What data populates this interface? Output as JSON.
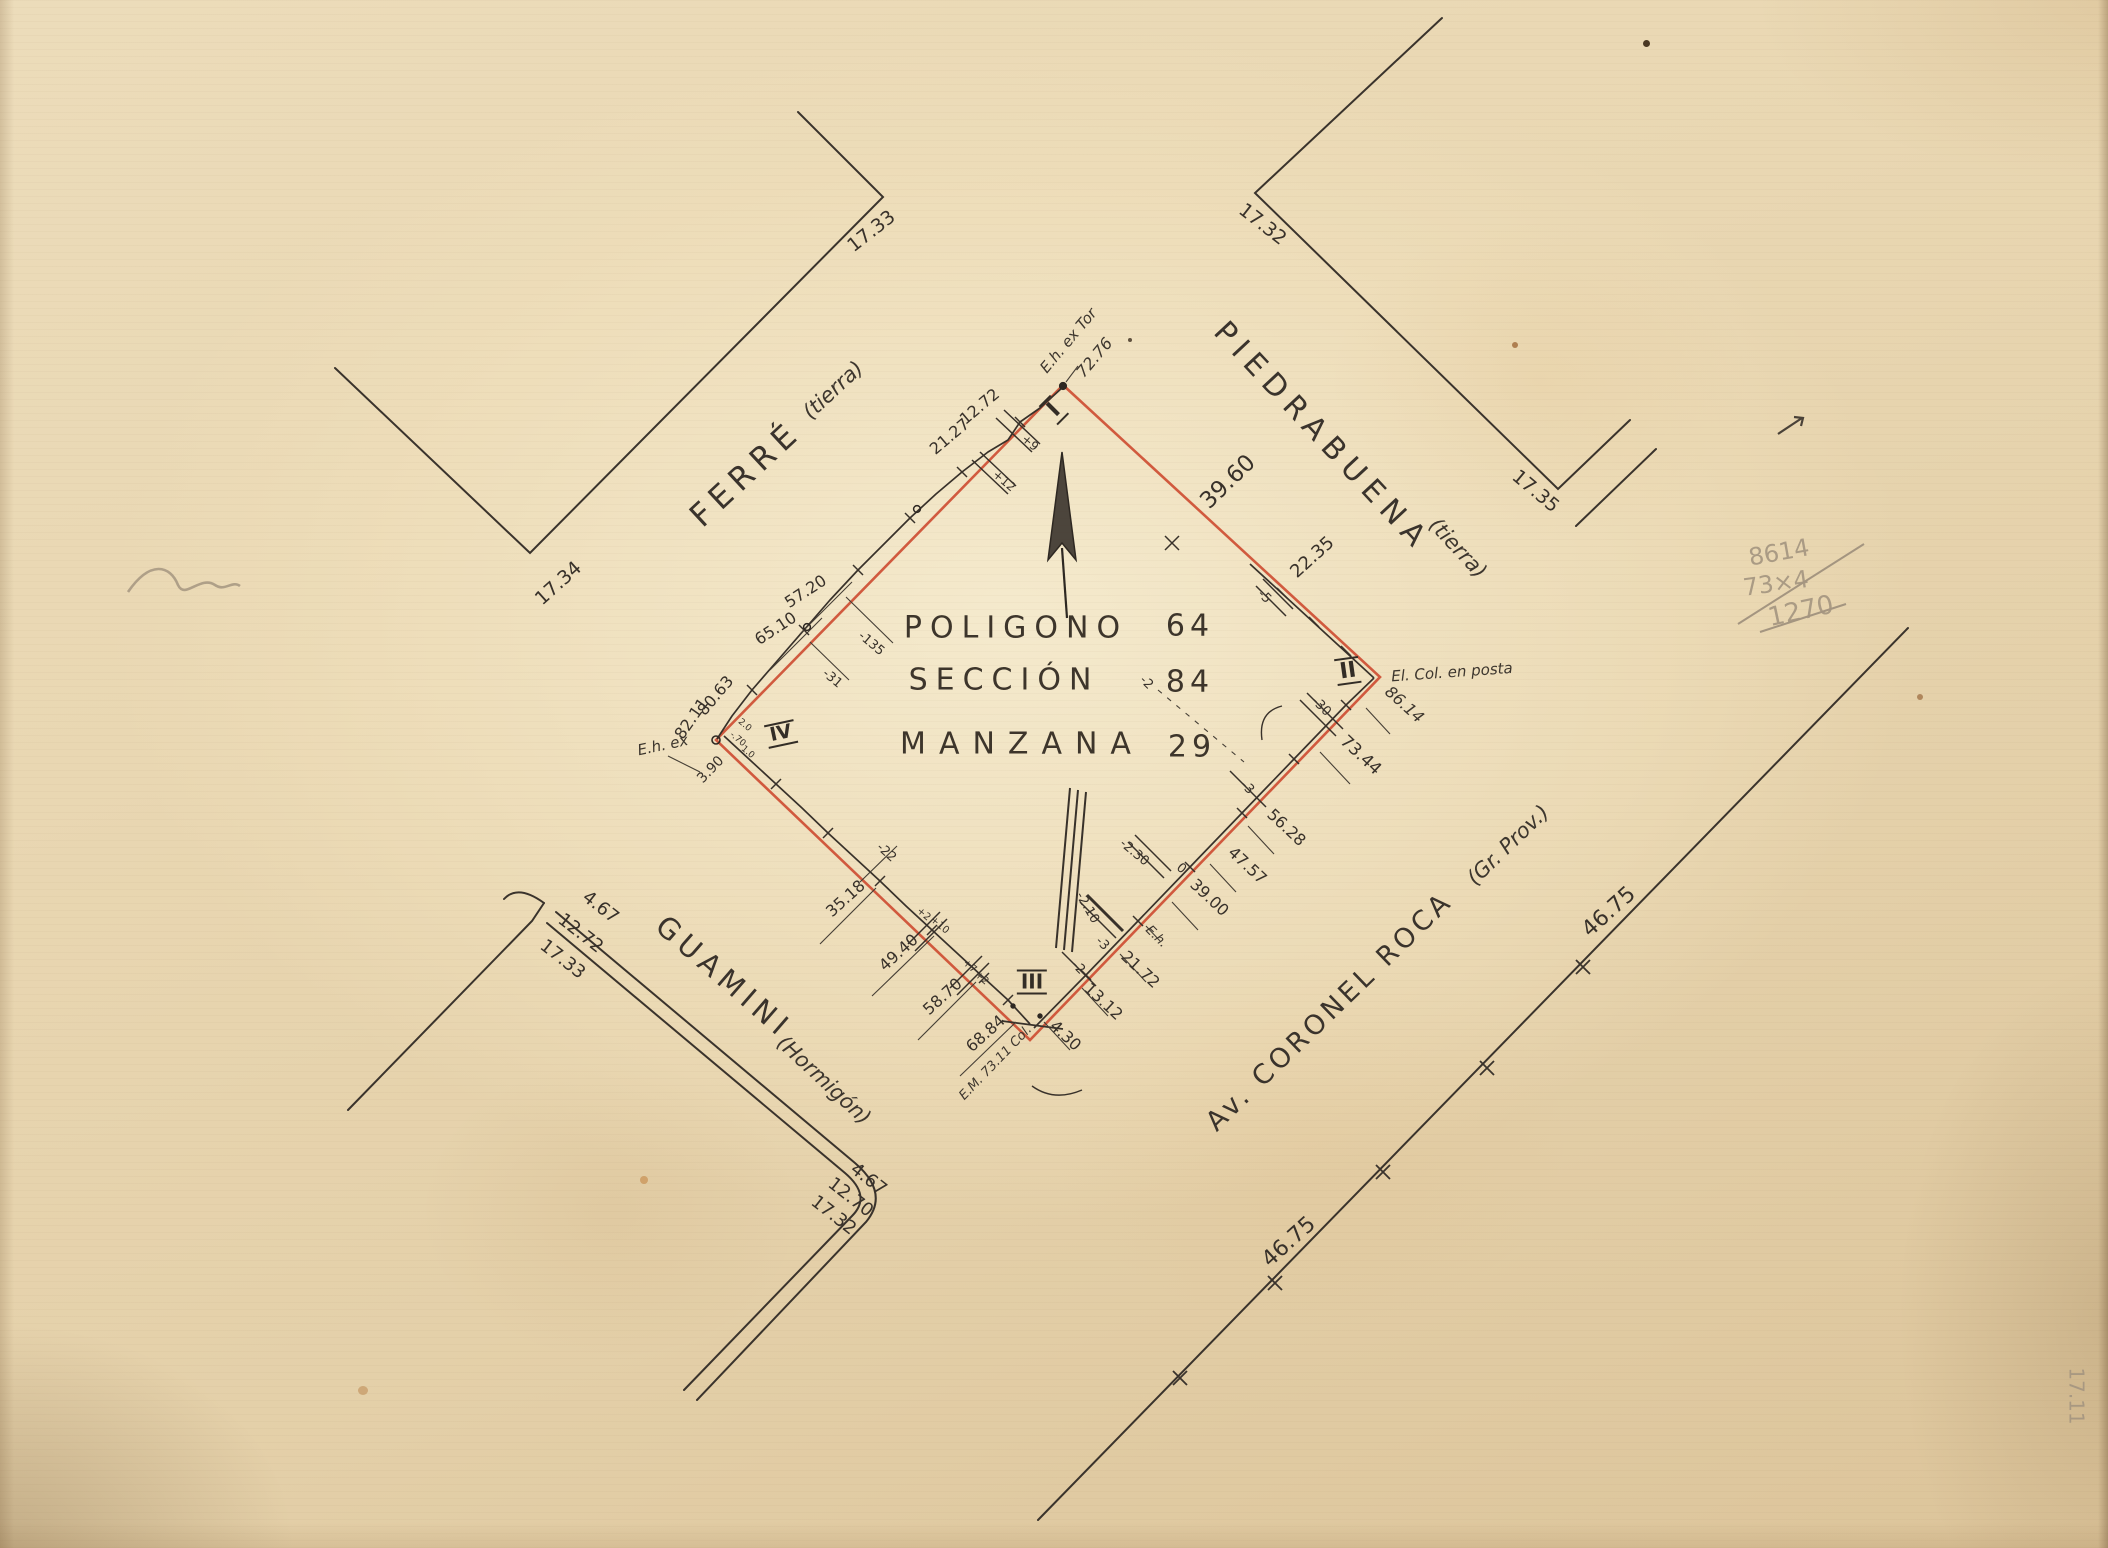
{
  "document": {
    "kind": "hand-drawn cadastral survey plan, scanned on aged paper",
    "block_title": {
      "polygon_label": "POLIGONO",
      "polygon_value": "64",
      "section_label": "SECCIÓN",
      "section_value": "84",
      "block_label": "MANZANA",
      "block_value": "29"
    }
  },
  "colors": {
    "boundary_red": "#cd4a30",
    "ink": "#38312a",
    "pencil": "#a49580",
    "paper": "#e9d7b2"
  },
  "labels": {
    "title": [
      {
        "id": "title-poligono",
        "text": "POLIGONO",
        "x": 1016,
        "y": 628,
        "rot": 0,
        "size": 30,
        "ls": 8,
        "style": "title"
      },
      {
        "id": "title-poligono-value",
        "text": "64",
        "x": 1190,
        "y": 626,
        "rot": 0,
        "size": 30,
        "ls": 5,
        "style": "title"
      },
      {
        "id": "title-seccion",
        "text": "SECCIÓN",
        "x": 1004,
        "y": 680,
        "rot": 0,
        "size": 30,
        "ls": 8,
        "style": "title"
      },
      {
        "id": "title-seccion-value",
        "text": "84",
        "x": 1190,
        "y": 682,
        "rot": 0,
        "size": 30,
        "ls": 5,
        "style": "title"
      },
      {
        "id": "title-manzana",
        "text": "MANZANA",
        "x": 1022,
        "y": 744,
        "rot": 0,
        "size": 30,
        "ls": 13,
        "style": "title"
      },
      {
        "id": "title-manzana-value",
        "text": "29",
        "x": 1192,
        "y": 747,
        "rot": 0,
        "size": 30,
        "ls": 5,
        "style": "title"
      }
    ],
    "streets": [
      {
        "id": "street-ferre",
        "text": "FERRÉ",
        "x": 746,
        "y": 474,
        "rot": -43,
        "size": 32,
        "ls": 7,
        "style": "street"
      },
      {
        "id": "street-ferre-surface",
        "text": "(tierra)",
        "x": 833,
        "y": 390,
        "rot": -43,
        "size": 21,
        "style": "hand"
      },
      {
        "id": "street-piedrabuena",
        "text": "PIEDRABUENA",
        "x": 1322,
        "y": 437,
        "rot": 47,
        "size": 30,
        "ls": 8,
        "style": "street"
      },
      {
        "id": "street-piedrabuena-surface",
        "text": "(tierra)",
        "x": 1458,
        "y": 548,
        "rot": 47,
        "size": 21,
        "style": "hand"
      },
      {
        "id": "street-guamini",
        "text": "GUAMINI",
        "x": 724,
        "y": 977,
        "rot": 41,
        "size": 29,
        "ls": 6,
        "style": "street"
      },
      {
        "id": "street-guamini-surface",
        "text": "(Hormigón)",
        "x": 824,
        "y": 1080,
        "rot": 43,
        "size": 21,
        "style": "hand"
      },
      {
        "id": "street-coronel-roca",
        "text": "Av. CORONEL ROCA",
        "x": 1330,
        "y": 1012,
        "rot": -44,
        "size": 27,
        "ls": 4,
        "style": "street"
      },
      {
        "id": "street-coronel-roca-surface",
        "text": "(Gr. Prov.)",
        "x": 1508,
        "y": 845,
        "rot": -44,
        "size": 21,
        "style": "hand"
      }
    ],
    "corner_dimensions": [
      {
        "id": "corner-dim",
        "text": "17.33",
        "x": 872,
        "y": 232,
        "rot": -38,
        "size": 19
      },
      {
        "id": "corner-dim",
        "text": "17.32",
        "x": 1262,
        "y": 225,
        "rot": 38,
        "size": 19
      },
      {
        "id": "corner-dim",
        "text": "17.34",
        "x": 559,
        "y": 584,
        "rot": -42,
        "size": 19
      },
      {
        "id": "corner-dim",
        "text": "17.35",
        "x": 1535,
        "y": 492,
        "rot": 40,
        "size": 19
      },
      {
        "id": "corner-dim",
        "text": "4.67",
        "x": 600,
        "y": 908,
        "rot": 38,
        "size": 18
      },
      {
        "id": "corner-dim",
        "text": "12.72",
        "x": 580,
        "y": 934,
        "rot": 38,
        "size": 18
      },
      {
        "id": "corner-dim",
        "text": "17.33",
        "x": 562,
        "y": 960,
        "rot": 38,
        "size": 18
      },
      {
        "id": "corner-dim",
        "text": "4.67",
        "x": 868,
        "y": 1180,
        "rot": 38,
        "size": 18
      },
      {
        "id": "corner-dim",
        "text": "12.70",
        "x": 850,
        "y": 1198,
        "rot": 38,
        "size": 18
      },
      {
        "id": "corner-dim",
        "text": "17.32",
        "x": 833,
        "y": 1216,
        "rot": 38,
        "size": 18
      },
      {
        "id": "roca-dim",
        "text": "46.75",
        "x": 1609,
        "y": 912,
        "rot": -42,
        "size": 22
      },
      {
        "id": "roca-dim",
        "text": "46.75",
        "x": 1289,
        "y": 1242,
        "rot": -42,
        "size": 22
      }
    ],
    "vertex_marks": [
      {
        "id": "vertex-i",
        "text": "I",
        "x": 1054,
        "y": 410,
        "rot": -45,
        "size": 22,
        "style": "roman"
      },
      {
        "id": "vertex-ii",
        "text": "II",
        "x": 1348,
        "y": 671,
        "rot": -8,
        "size": 22,
        "style": "roman"
      },
      {
        "id": "vertex-iii",
        "text": "III",
        "x": 1032,
        "y": 982,
        "rot": 0,
        "size": 20,
        "style": "roman"
      },
      {
        "id": "vertex-iv",
        "text": "IV",
        "x": 781,
        "y": 734,
        "rot": -12,
        "size": 19,
        "style": "roman"
      }
    ],
    "monuments": [
      {
        "id": "monument-note",
        "text": "E.h. ex Tor",
        "x": 1069,
        "y": 341,
        "rot": -50,
        "size": 15,
        "style": "hand"
      },
      {
        "id": "monument-note",
        "text": "72.76",
        "x": 1095,
        "y": 358,
        "rot": -50,
        "size": 16,
        "style": "hand"
      },
      {
        "id": "monument-note",
        "text": "El. Col. en posta",
        "x": 1452,
        "y": 673,
        "rot": -4,
        "size": 15,
        "style": "hand"
      },
      {
        "id": "monument-note",
        "text": "86.14",
        "x": 1404,
        "y": 705,
        "rot": 42,
        "size": 16,
        "style": "hand"
      },
      {
        "id": "monument-note",
        "text": "E.h. ex",
        "x": 663,
        "y": 746,
        "rot": -12,
        "size": 15,
        "style": "hand"
      },
      {
        "id": "monument-note",
        "text": "E.M. 73.11 Col.",
        "x": 996,
        "y": 1063,
        "rot": -46,
        "size": 13,
        "style": "hand"
      },
      {
        "id": "monument-note",
        "text": "E.h.",
        "x": 1156,
        "y": 937,
        "rot": 45,
        "size": 13,
        "style": "hand"
      }
    ],
    "edge_dimensions": [
      {
        "id": "edge-dim",
        "text": "39.60",
        "x": 1228,
        "y": 482,
        "rot": -44,
        "size": 23
      },
      {
        "id": "edge-dim",
        "text": "22.35",
        "x": 1313,
        "y": 558,
        "rot": -42,
        "size": 18
      },
      {
        "id": "edge-dim",
        "text": "12.72",
        "x": 980,
        "y": 407,
        "rot": -40,
        "size": 16
      },
      {
        "id": "edge-dim",
        "text": "21.27",
        "x": 950,
        "y": 437,
        "rot": -40,
        "size": 16
      },
      {
        "id": "edge-dim",
        "text": "57.20",
        "x": 806,
        "y": 592,
        "rot": -33,
        "size": 16
      },
      {
        "id": "edge-dim",
        "text": "65.10",
        "x": 776,
        "y": 629,
        "rot": -33,
        "size": 16
      },
      {
        "id": "edge-dim",
        "text": "80.63",
        "x": 716,
        "y": 696,
        "rot": -50,
        "size": 16
      },
      {
        "id": "edge-dim",
        "text": "82.11",
        "x": 692,
        "y": 719,
        "rot": -55,
        "size": 16
      },
      {
        "id": "edge-dim",
        "text": "3.90",
        "x": 711,
        "y": 770,
        "rot": -46,
        "size": 14
      },
      {
        "id": "edge-dim",
        "text": "35.18",
        "x": 846,
        "y": 899,
        "rot": -42,
        "size": 16
      },
      {
        "id": "edge-dim",
        "text": "49.40",
        "x": 899,
        "y": 953,
        "rot": -42,
        "size": 16
      },
      {
        "id": "edge-dim",
        "text": "58.70",
        "x": 943,
        "y": 997,
        "rot": -42,
        "size": 16
      },
      {
        "id": "edge-dim",
        "text": "68.84",
        "x": 986,
        "y": 1034,
        "rot": -42,
        "size": 16
      },
      {
        "id": "edge-dim",
        "text": "4.30",
        "x": 1065,
        "y": 1036,
        "rot": 43,
        "size": 16
      },
      {
        "id": "edge-dim",
        "text": "13.12",
        "x": 1103,
        "y": 1002,
        "rot": 43,
        "size": 16
      },
      {
        "id": "edge-dim",
        "text": "21.72",
        "x": 1140,
        "y": 970,
        "rot": 43,
        "size": 16
      },
      {
        "id": "edge-dim",
        "text": "39.00",
        "x": 1209,
        "y": 898,
        "rot": 43,
        "size": 16
      },
      {
        "id": "edge-dim",
        "text": "47.57",
        "x": 1247,
        "y": 866,
        "rot": 43,
        "size": 16
      },
      {
        "id": "edge-dim",
        "text": "56.28",
        "x": 1286,
        "y": 828,
        "rot": 43,
        "size": 16
      },
      {
        "id": "edge-dim",
        "text": "73.44",
        "x": 1360,
        "y": 756,
        "rot": 43,
        "size": 17
      }
    ],
    "offsets": [
      {
        "id": "offset-dim",
        "text": "+9",
        "x": 1030,
        "y": 443,
        "rot": 40,
        "size": 12
      },
      {
        "id": "offset-dim",
        "text": "+12",
        "x": 1004,
        "y": 481,
        "rot": 40,
        "size": 12
      },
      {
        "id": "offset-dim",
        "text": "-135",
        "x": 871,
        "y": 644,
        "rot": 40,
        "size": 13
      },
      {
        "id": "offset-dim",
        "text": "-31",
        "x": 832,
        "y": 679,
        "rot": 40,
        "size": 13
      },
      {
        "id": "offset-dim",
        "text": "-5",
        "x": 1264,
        "y": 597,
        "rot": 45,
        "size": 13
      },
      {
        "id": "offset-dim",
        "text": "-30",
        "x": 1321,
        "y": 707,
        "rot": 45,
        "size": 13
      },
      {
        "id": "offset-dim",
        "text": "-3",
        "x": 1247,
        "y": 788,
        "rot": 45,
        "size": 13
      },
      {
        "id": "offset-dim",
        "text": "-2",
        "x": 1146,
        "y": 683,
        "rot": 45,
        "size": 13
      },
      {
        "id": "offset-dim",
        "text": "-2.30",
        "x": 1134,
        "y": 853,
        "rot": 40,
        "size": 13
      },
      {
        "id": "offset-dim",
        "text": "0",
        "x": 1181,
        "y": 869,
        "rot": 40,
        "size": 13
      },
      {
        "id": "offset-dim",
        "text": "-2.10",
        "x": 1087,
        "y": 908,
        "rot": 60,
        "size": 13
      },
      {
        "id": "offset-dim",
        "text": "-3",
        "x": 1102,
        "y": 944,
        "rot": 45,
        "size": 13
      },
      {
        "id": "offset-dim",
        "text": "-2",
        "x": 1078,
        "y": 968,
        "rot": 45,
        "size": 13
      },
      {
        "id": "offset-dim",
        "text": "-22",
        "x": 886,
        "y": 853,
        "rot": 42,
        "size": 13
      },
      {
        "id": "offset-dim",
        "text": "+2",
        "x": 923,
        "y": 915,
        "rot": 40,
        "size": 10
      },
      {
        "id": "offset-dim",
        "text": "+10",
        "x": 939,
        "y": 926,
        "rot": 40,
        "size": 10
      },
      {
        "id": "offset-dim",
        "text": "+7",
        "x": 969,
        "y": 967,
        "rot": 40,
        "size": 10
      },
      {
        "id": "offset-dim",
        "text": "+2",
        "x": 981,
        "y": 979,
        "rot": 40,
        "size": 10
      },
      {
        "id": "offset-dim",
        "text": "2.0",
        "x": 744,
        "y": 726,
        "rot": 40,
        "size": 9
      },
      {
        "id": "offset-dim",
        "text": "-.70",
        "x": 737,
        "y": 740,
        "rot": 40,
        "size": 9
      },
      {
        "id": "offset-dim",
        "text": "1.0",
        "x": 747,
        "y": 753,
        "rot": 40,
        "size": 9
      }
    ],
    "pencil_notes": [
      {
        "id": "pencil-calc-line",
        "text": "8614",
        "x": 1779,
        "y": 553,
        "rot": -10,
        "size": 24,
        "style": "pencil"
      },
      {
        "id": "pencil-calc-line",
        "text": "73×4",
        "x": 1776,
        "y": 584,
        "rot": -8,
        "size": 24,
        "style": "pencil"
      },
      {
        "id": "pencil-calc-line",
        "text": "1270",
        "x": 1801,
        "y": 612,
        "rot": -12,
        "size": 26,
        "style": "pencil"
      },
      {
        "id": "pencil-margin-note",
        "text": "17.11",
        "x": 2076,
        "y": 1396,
        "rot": 90,
        "size": 20,
        "style": "pencil"
      }
    ]
  }
}
